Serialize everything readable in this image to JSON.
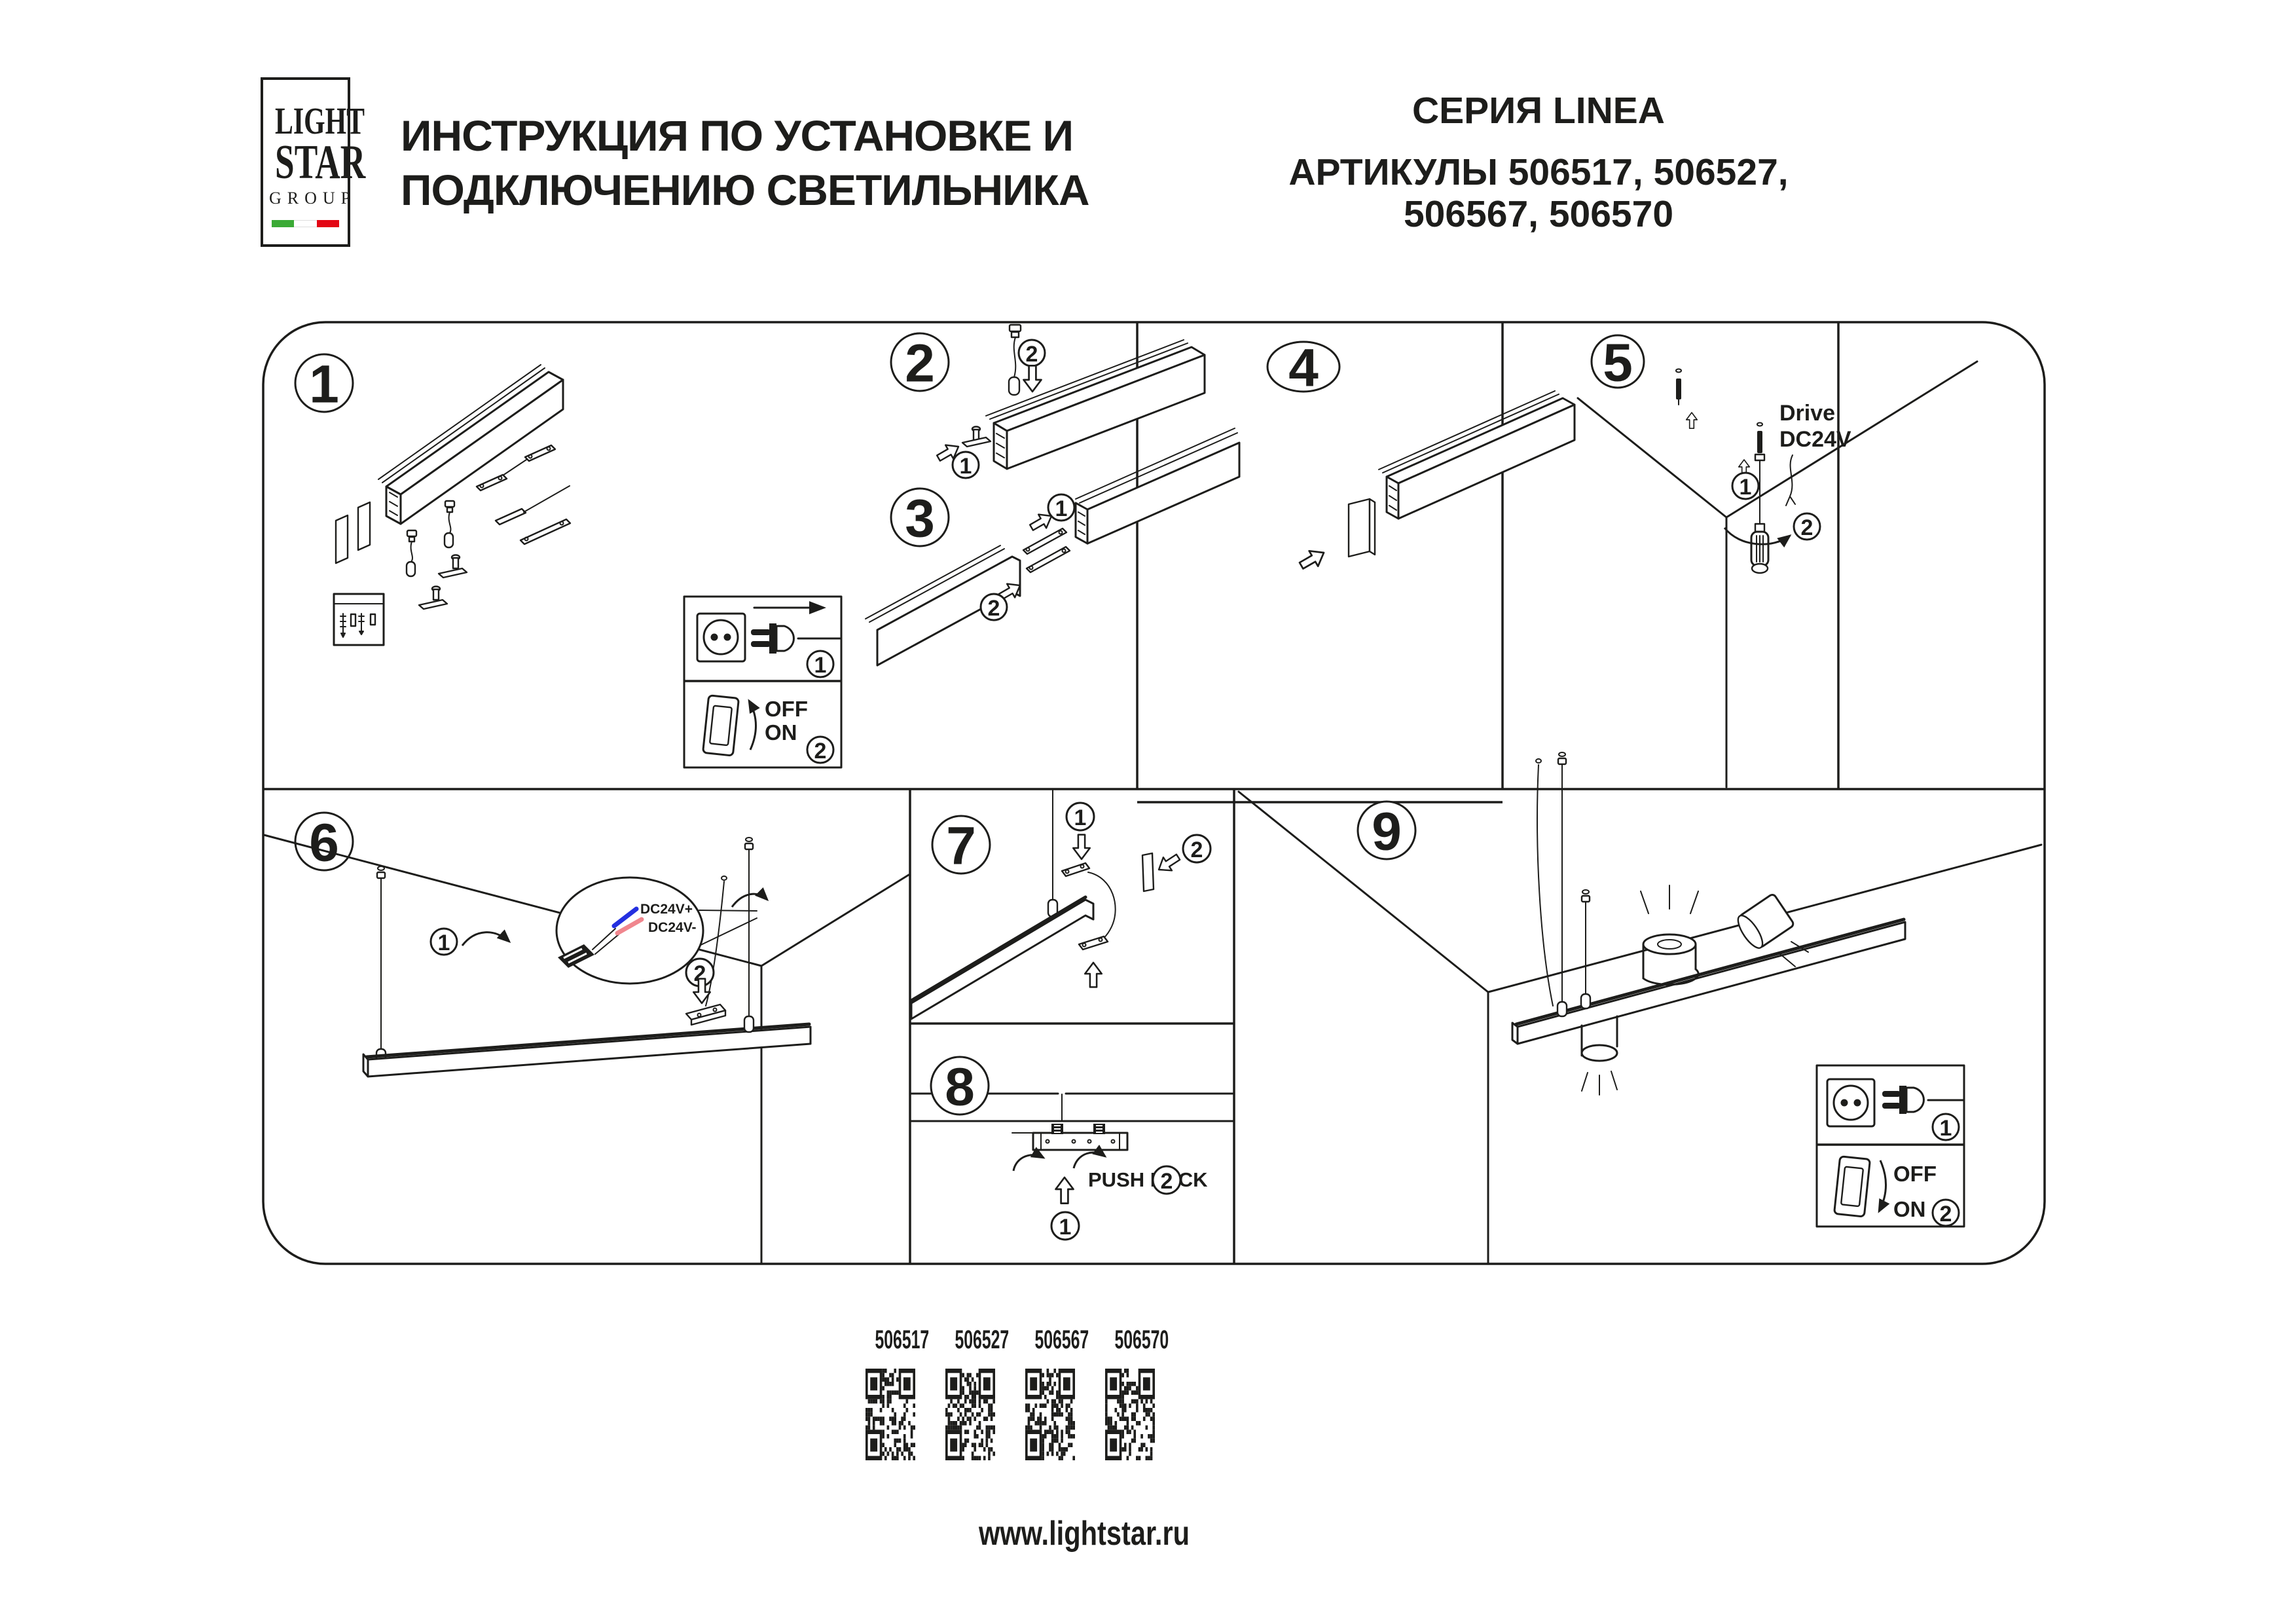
{
  "header": {
    "logo": {
      "line1": "LIGHT",
      "line2": "STAR",
      "line3": "GROUP"
    },
    "title_line1": "ИНСТРУКЦИЯ ПО УСТАНОВКЕ И",
    "title_line2": "ПОДКЛЮЧЕНИЮ СВЕТИЛЬНИКА",
    "series": "СЕРИЯ LINEA",
    "articles_line1": "АРТИКУЛЫ 506517, 506527,",
    "articles_line2": "506567, 506570"
  },
  "sections": {
    "n1": "1",
    "n2": "2",
    "n3": "3",
    "n4": "4",
    "n5": "5",
    "n6": "6",
    "n7": "7",
    "n8": "8",
    "n9": "9"
  },
  "callout": {
    "c1": "1",
    "c2": "2"
  },
  "labels": {
    "drive_line1": "Drive",
    "drive_line2": "DC24V",
    "wire_positive": "DC24V+",
    "wire_negative": "DC24V-",
    "push_lock": "PUSH LOCK",
    "switch_off": "OFF",
    "switch_on": "ON"
  },
  "qr_codes": [
    {
      "label": "506517"
    },
    {
      "label": "506527"
    },
    {
      "label": "506567"
    },
    {
      "label": "506570"
    }
  ],
  "footer": {
    "website": "www.lightstar.ru"
  },
  "colors": {
    "line": "#1d1d1b",
    "wire_positive_blue": "#2430e0",
    "wire_negative_pink": "#f0868e",
    "flag_green": "#3aaa35",
    "flag_white": "#ffffff",
    "flag_red": "#e30613"
  }
}
